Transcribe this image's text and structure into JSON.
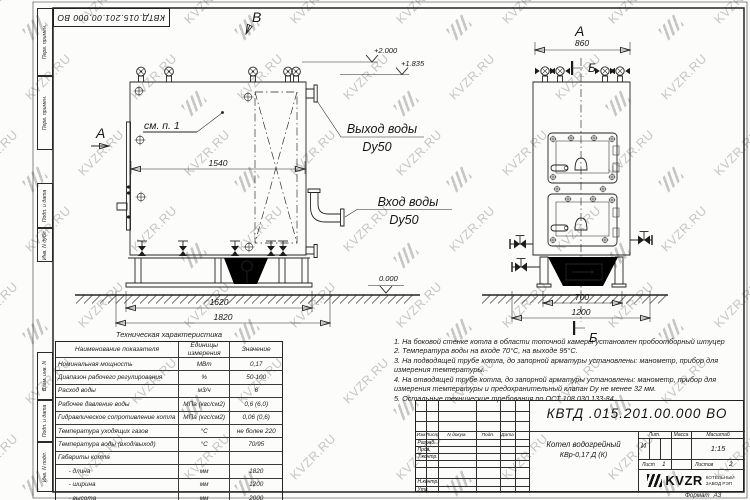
{
  "watermark": {
    "text": "KVZR.RU"
  },
  "frame": {
    "corner_number": "КВТД.015.201.00.000  ВО",
    "side_labels": [
      "Перв. примен.",
      "Перв. примен.",
      "Подп. и дата",
      "Инв. N дубл.",
      "Взам. инв. N",
      "Подп. и дата",
      "Инв. N подл."
    ]
  },
  "front_view": {
    "label_a": "А",
    "label_b": "В",
    "see_note": "см. п. 1",
    "outlet_line1": "Выход воды",
    "outlet_line2": "Dy50",
    "inlet_line1": "Вход воды",
    "inlet_line2": "Dy50",
    "dim_inner": "1540",
    "dim_base": "1620",
    "dim_total": "1820",
    "elev_top": "+2.000",
    "elev_mid": "+1.835",
    "elev_zero": "0.000"
  },
  "side_view": {
    "label_a": "А",
    "label_b": "Б",
    "dim_top": "860",
    "dim_base": "700",
    "dim_total": "1200"
  },
  "tech_table": {
    "title": "Техническая характеристика",
    "headers": [
      "Наименование показателя",
      "Единицы измерения",
      "Значение"
    ],
    "rows": [
      [
        "Номинальная мощность",
        "МВт",
        "0,17"
      ],
      [
        "Диапазон рабочего регулирования",
        "%",
        "50-100"
      ],
      [
        "Расход воды",
        "м3/ч",
        "6"
      ],
      [
        "Рабочее давление воды",
        "МПа (кгс/см2)",
        "0,6 (6,0)"
      ],
      [
        "Гидравлическое сопротивление котла",
        "МПа (кгс/см2)",
        "0,06 (0,6)"
      ],
      [
        "Температура уходящих газов",
        "°С",
        "не более 220"
      ],
      [
        "Температура воды (вход/выход)",
        "°С",
        "70/95"
      ],
      [
        "Габариты котла",
        "",
        ""
      ],
      [
        "      - длина",
        "мм",
        "1820"
      ],
      [
        "      - ширина",
        "мм",
        "1200"
      ],
      [
        "      - высота",
        "мм",
        "2000"
      ]
    ]
  },
  "notes": [
    "1.  На боковой стенке котла в области топочной камеры установлен пробоотборный штуцер",
    "2.  Температура воды на входе  70°С,  на выходе  95°С.",
    "3.  На подводящей трубе котла, до запорной арматуры установлены:  манометр,  прибор для измерения температуры.",
    "4.  На отводящей трубе котла, до запорной арматуры установлены:  манометр,  прибор для измерения температуры и  предохранительный клапан  Dу не менее  32  мм.",
    "5.  Остальные технические требования по ОСТ  108.030.133-84."
  ],
  "title_block": {
    "doc_number": "КВТД .015.201.00.000   ВО",
    "columns": [
      "Изм",
      "Лист",
      "N докум.",
      "Подп.",
      "Дата"
    ],
    "row_labels": [
      "Разраб.",
      "Пров.",
      "Т.контр.",
      "Н.контр.",
      "Утв."
    ],
    "product_name_line1": "Котел водогрейный",
    "product_name_line2": "КВр-0,17  Д  (К)",
    "lit_header": "Лит.",
    "mass_header": "Масса",
    "scale_header": "Масштаб",
    "lit_value": "И",
    "scale_value": "1:15",
    "sheet_label": "Лист",
    "sheet_value": "1",
    "sheets_label": "Листов",
    "sheets_value": "2",
    "company_logo": "KVZR",
    "company_name_line1": "КОТЕЛЬНЫЙ",
    "company_name_line2": "ЗАВОД РЭП",
    "format_label": "Формат",
    "format_value": "А3"
  }
}
